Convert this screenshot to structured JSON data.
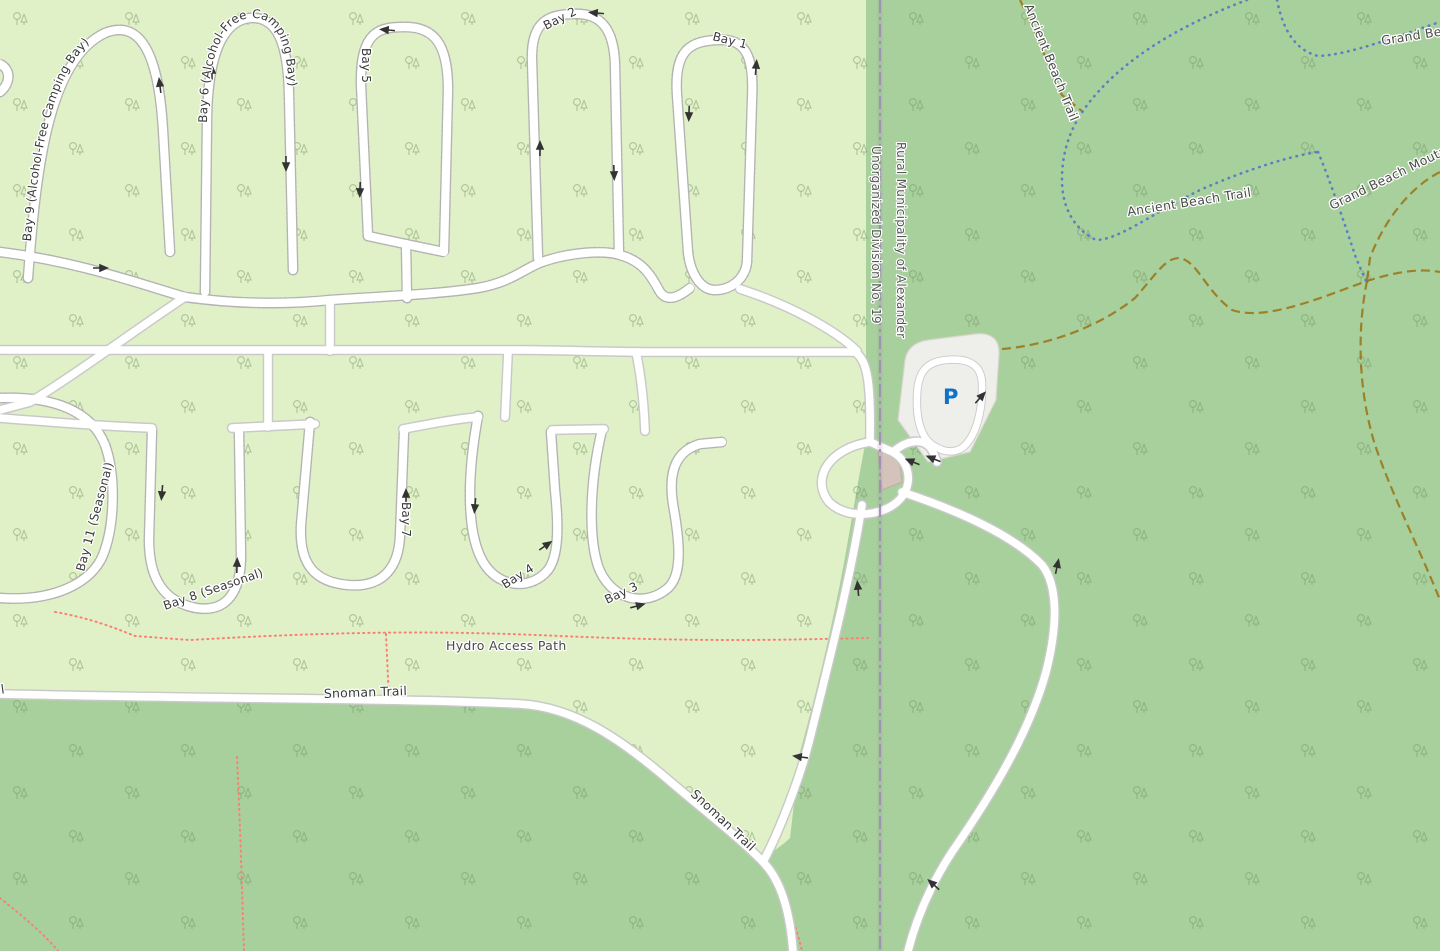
{
  "map": {
    "title": "Grand Beach campground map",
    "labels": {
      "bay9": "Bay 9 (Alcohol-Free Camping Bay)",
      "bay6": "Bay 6 (Alcohol-Free Camping Bay)",
      "bay5": "Bay 5",
      "bay2": "Bay 2",
      "bay1": "Bay 1",
      "bay11": "Bay 11 (Seasonal)",
      "bay8": "Bay 8 (Seasonal)",
      "bay7": "Bay 7",
      "bay4": "Bay 4",
      "bay3": "Bay 3",
      "hydro_access_path": "Hydro Access Path",
      "snoman_trail": "Snoman Trail",
      "boundary_left": "Unorganized Division No. 19",
      "boundary_right": "Rural Municipality of Alexander",
      "ancient_beach_trail": "Ancient Beach Trail",
      "grand_beach": "Grand Beach",
      "grand_beach_moutain": "Grand Beach Moutain B",
      "parking": "P"
    },
    "icons": {
      "parking_icon": "P",
      "oneway_arrow": "one-way direction arrow",
      "tree_icon": "tree pair symbol"
    },
    "colors": {
      "campground": "#e0f1c7",
      "forest": "#a8d09c",
      "tree": "#6f8f5f",
      "road": "#ffffff",
      "road_casing": "#c9c9c9",
      "stipple": "#b3b3b3",
      "track": "#996600",
      "path": "#fa8072",
      "cycleway": "#5b7fc3",
      "boundary": "#9b8fae",
      "parking_fill": "#eeeeea",
      "parking_edge": "#d9d5cd",
      "parking_p": "#0d72c8",
      "building": "#d4c3bb",
      "label": "#3a3a3a",
      "boundary_label": "#565656",
      "trail_label": "#4a4a4a",
      "arrow": "#333333"
    }
  }
}
